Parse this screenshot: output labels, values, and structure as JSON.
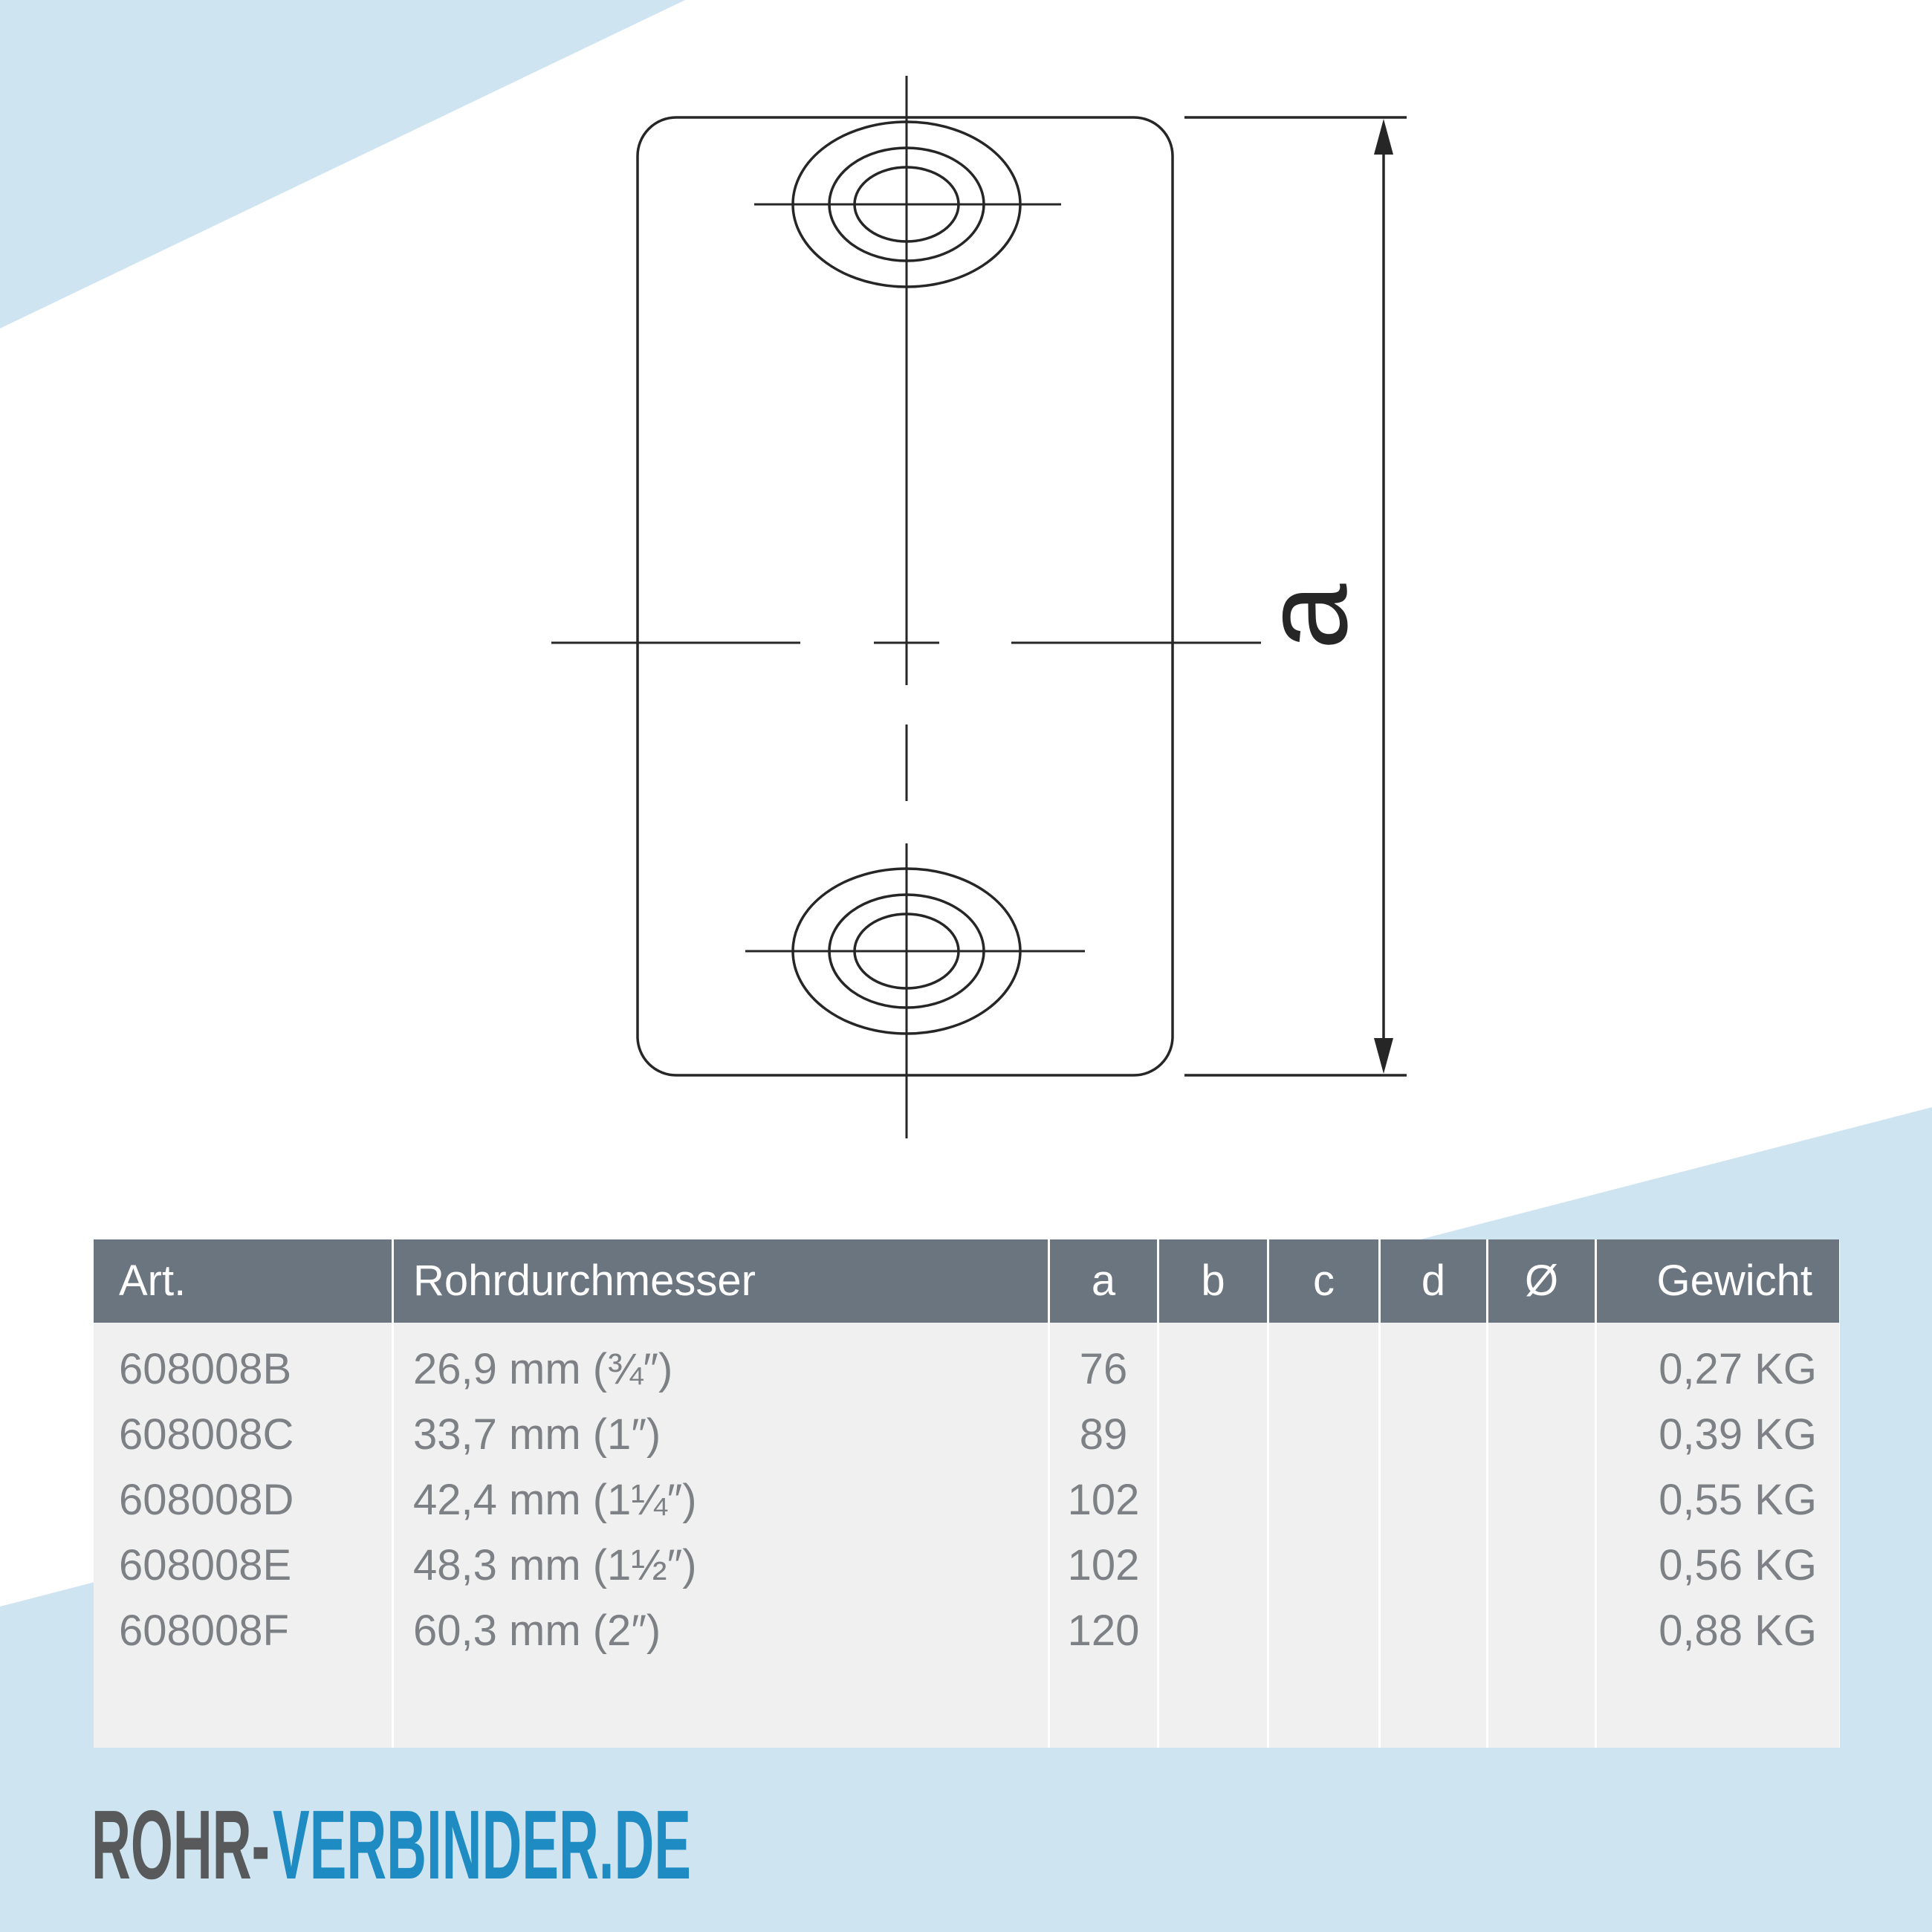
{
  "colors": {
    "accent_blue_light": "#cfe4f1",
    "table_header_slate": "#6b7580",
    "table_body_gray": "#f0f0f0",
    "table_row_text": "#7d8084",
    "header_text": "#ffffff",
    "drawing_line": "#262626",
    "logo_gray": "#58595b",
    "logo_blue": "#1e8bc3"
  },
  "drawing": {
    "dimension_label": "a"
  },
  "table": {
    "headers": [
      "Art.",
      "Rohrdurchmesser",
      "a",
      "b",
      "c",
      "d",
      "Ø",
      "Gewicht"
    ],
    "rows": [
      [
        "608008B",
        "26,9 mm (¾″)",
        "76",
        "",
        "",
        "",
        "",
        "0,27 KG"
      ],
      [
        "608008C",
        "33,7 mm (1″)",
        "89",
        "",
        "",
        "",
        "",
        "0,39 KG"
      ],
      [
        "608008D",
        "42,4 mm (1¼″)",
        "102",
        "",
        "",
        "",
        "",
        "0,55 KG"
      ],
      [
        "608008E",
        "48,3 mm (1½″)",
        "102",
        "",
        "",
        "",
        "",
        "0,56 KG"
      ],
      [
        "608008F",
        "60,3 mm (2″)",
        "120",
        "",
        "",
        "",
        "",
        "0,88 KG"
      ]
    ]
  },
  "logo": {
    "part1": "ROHR-",
    "part2": "VERBINDER.DE"
  }
}
